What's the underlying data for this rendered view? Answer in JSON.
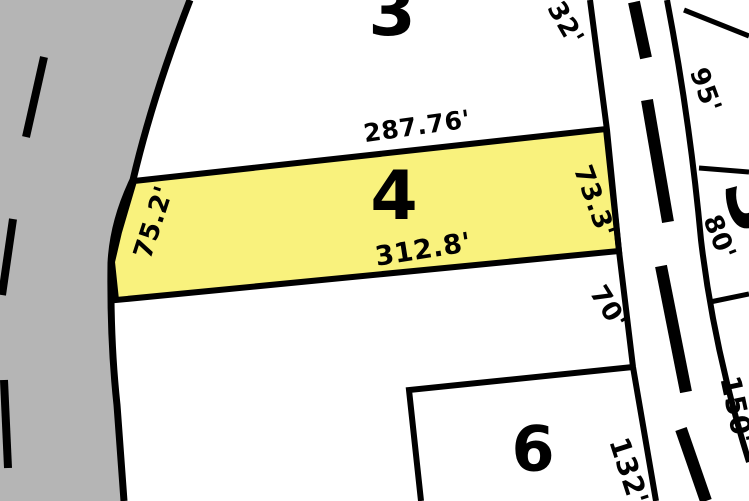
{
  "map": {
    "type": "parcel-plat-map",
    "colors": {
      "road_fill": "#b5b5b5",
      "selected_lot_fill": "#f9f27d",
      "line_color": "#000000",
      "background": "#ffffff"
    },
    "lots": {
      "lot_3": {
        "number": "3",
        "road_frontage": "32'"
      },
      "lot_4": {
        "number": "4",
        "north_dim": "287.76'",
        "south_dim": "312.8'",
        "west_dim": "75.2'",
        "east_dim": "73.3'"
      },
      "lot_5": {
        "road_frontage": "70'"
      },
      "lot_6": {
        "number": "6",
        "road_frontage": "132'"
      },
      "east_block": {
        "number": "3",
        "frontage_north": "95'",
        "frontage_mid": "80'",
        "frontage_south": "150'"
      }
    }
  }
}
